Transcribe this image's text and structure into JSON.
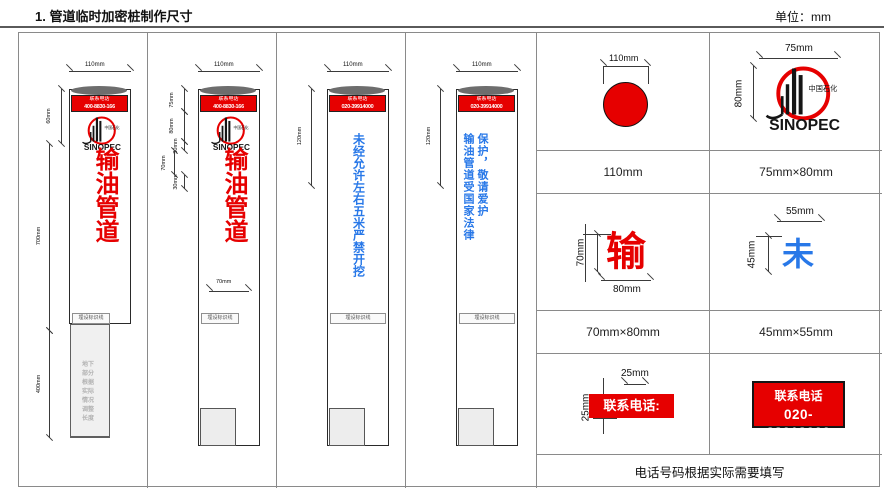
{
  "header": {
    "title": "1. 管道临时加密桩制作尺寸",
    "unit": "单位：mm"
  },
  "logo": {
    "cn": "中国石化",
    "en": "SINOPEC"
  },
  "piles": [
    {
      "width_dim": "110mm",
      "dims": [
        "60mm",
        "700mm",
        "400mm"
      ],
      "phone": {
        "label": "联系电话",
        "number": "400-8830-166"
      },
      "body": "输油管道",
      "marker": "埋设标识线",
      "underground": "地下部分根据实际情况调整长度"
    },
    {
      "width_dim": "110mm",
      "dims": [
        "75mm",
        "80mm",
        "30mm",
        "70mm",
        "30mm"
      ],
      "char_width_dim": "70mm",
      "phone": {
        "label": "联系电话",
        "number": "400-8830-166"
      },
      "body": "输油管道",
      "marker": "埋设标识线"
    },
    {
      "width_dim": "110mm",
      "dims": [
        "120mm"
      ],
      "phone": {
        "label": "联系电话",
        "number": "020-39914000"
      },
      "body": "未经允许左右五米严禁开挖",
      "marker": "埋设标识线"
    },
    {
      "width_dim": "110mm",
      "dims": [
        "120mm"
      ],
      "phone": {
        "label": "联系电话",
        "number": "020-39914000"
      },
      "body": "输油管道受国家法律保护，敬请爱护",
      "marker": "埋设标识线"
    }
  ],
  "details": {
    "circle": {
      "dim": "110mm",
      "caption": "110mm"
    },
    "logo": {
      "dim_w": "75mm",
      "dim_h": "80mm",
      "caption": "75mm×80mm"
    },
    "shu": {
      "char": "输",
      "dim_h": "70mm",
      "dim_w": "80mm",
      "caption": "70mm×80mm"
    },
    "wei": {
      "char": "未",
      "dim_w": "55mm",
      "dim_h": "45mm",
      "caption": "45mm×55mm"
    },
    "strip": {
      "text": "联系电话:",
      "dim_w": "25mm",
      "dim_h": "25mm"
    },
    "phone_box": {
      "label": "联系电话",
      "number": "020-38018000"
    },
    "note": "电话号码根据实际需要填写"
  },
  "colors": {
    "red": "#e60000",
    "blue": "#2878e8"
  }
}
